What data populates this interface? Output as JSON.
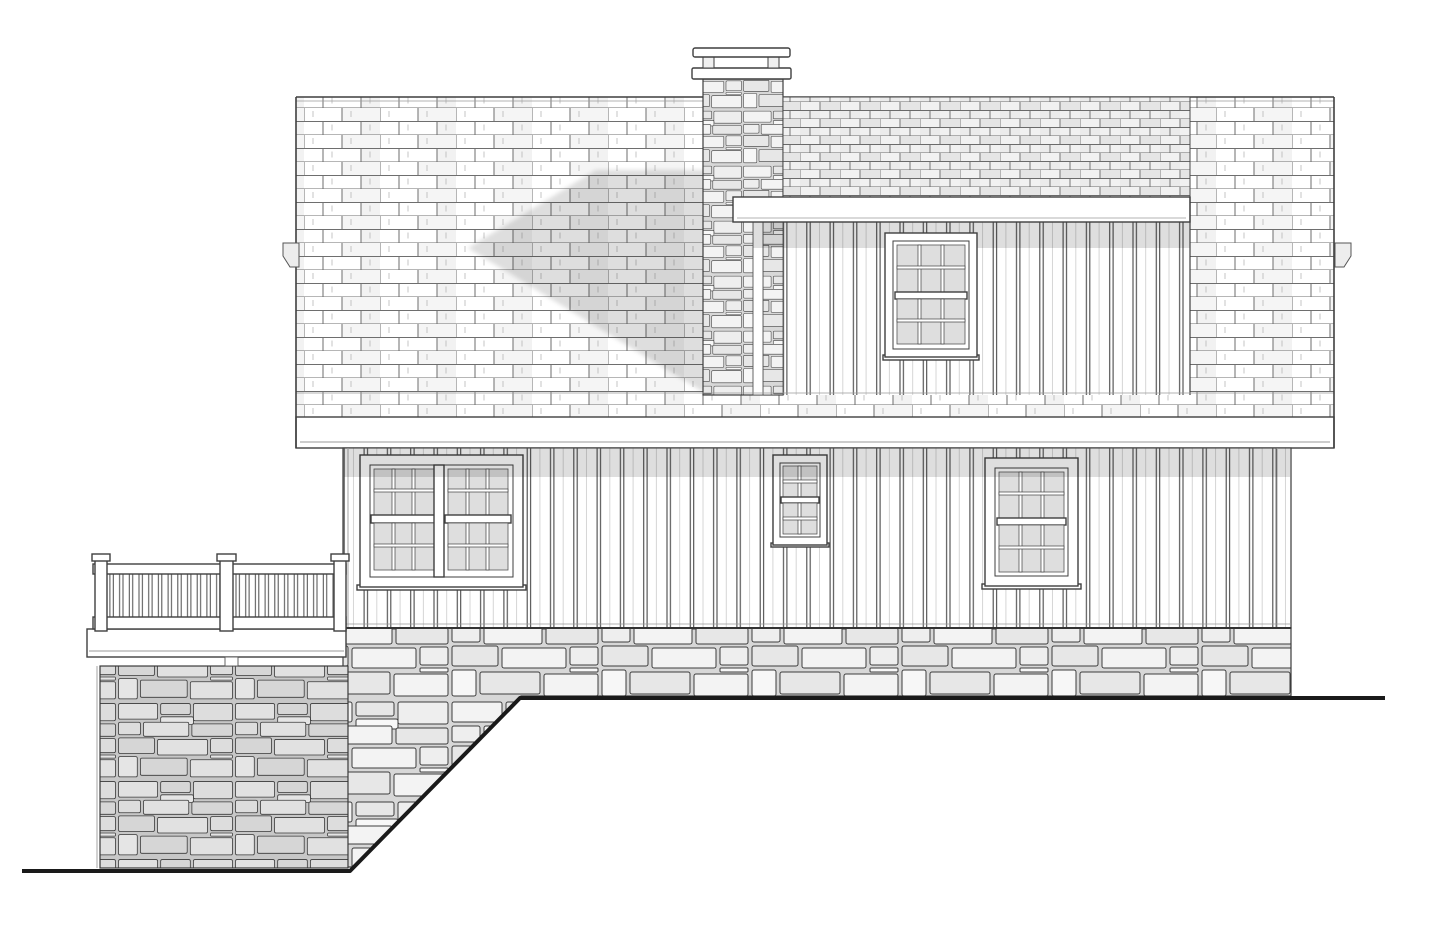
{
  "document": {
    "type": "architectural-elevation-drawing",
    "view": "side-elevation",
    "style": "black and white technical line drawing, no text or dimensions shown"
  },
  "palette": {
    "background": "#ffffff",
    "line": "#3f3f3f",
    "line_strong": "#1a1a1a",
    "line_soft": "#9a9a9a",
    "shingle_line": "#6e6e6e",
    "mortar": "#d7d7d7",
    "dense_roof_bg": "#f1f1f1",
    "glass": "#dedede",
    "shadow": "rgba(0,0,0,0.13)"
  },
  "elevation": {
    "main_roof": {
      "material": "shingles drawn as staggered brick-like courses",
      "courses_approx": 24,
      "features": [
        "horizontal ridge at top",
        "wide eave fascia band at bottom",
        "small gutter outlet bracket on left edge",
        "small gutter outlet bracket on right edge",
        "soft diagonal shadow cast by chimney onto roof plane"
      ]
    },
    "chimney": {
      "material": "irregular stone veneer",
      "cap": "two stacked flat cap slabs with short support blocks between",
      "position": "upper center-left, penetrates main roof"
    },
    "upper_dormer": {
      "roof": "low shed roof with dense small shingle courses",
      "fascia": "white horizontal fascia band",
      "siding": "vertical board-and-batten",
      "window": {
        "type": "double-hung",
        "sashes": 2,
        "panes_per_sash": "3 columns x 2 rows"
      }
    },
    "main_level": {
      "siding": "vertical board-and-batten",
      "shadow": "gray shadow band under the roof eave",
      "windows": [
        {
          "id": "left-double-window",
          "type": "twin double-hung",
          "units": 2,
          "panes_per_sash": "3 columns x 2 rows"
        },
        {
          "id": "center-small-window",
          "type": "double-hung",
          "units": 1,
          "panes_per_sash": "2 columns x 2 rows"
        },
        {
          "id": "right-window",
          "type": "double-hung",
          "units": 1,
          "panes_per_sash": "3 columns x 2 rows"
        }
      ]
    },
    "foundation": {
      "material": "irregular stacked stone veneer band",
      "note": "exposed height grows toward the left as grade falls"
    },
    "deck": {
      "location": "left side",
      "railing": {
        "style": "wood picket railing with square balusters",
        "posts": 3,
        "post_caps": true
      },
      "rim": "white deck rim/fascia band",
      "base": "tall shaded stone pier wall down to grade"
    },
    "grade": {
      "right_ground_line": "horizontal, under house",
      "slope": "drops diagonally down toward the left near the deck",
      "left_ground_line": "lower horizontal line at base of stone pier"
    }
  }
}
